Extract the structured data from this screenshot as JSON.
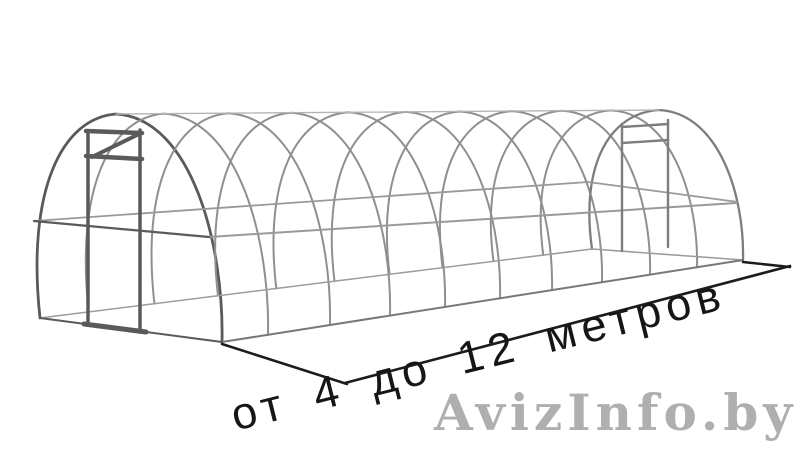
{
  "page": {
    "width": 800,
    "height": 452,
    "background": "#ffffff"
  },
  "illustration": {
    "name": "tunnel-greenhouse-frame-wireframe",
    "arch_count": 11,
    "colors": {
      "front_frame": "#5a5a5a",
      "arch": "#8f8f8f",
      "rear_arch": "#7d7d7d",
      "purlin": "#9a9a9a",
      "near_base": "#787878",
      "far_base": "#9c9c9c",
      "ridge": "#b4b4b4",
      "dimension_line": "#1c1c1c"
    }
  },
  "dimension": {
    "label": "от 4 до 12 метров",
    "from_meters": 4,
    "to_meters": 12,
    "unit": "метров",
    "text_color": "#161616"
  },
  "watermark": {
    "text": "AvizInfo.by",
    "color": "#a9a9a9"
  }
}
